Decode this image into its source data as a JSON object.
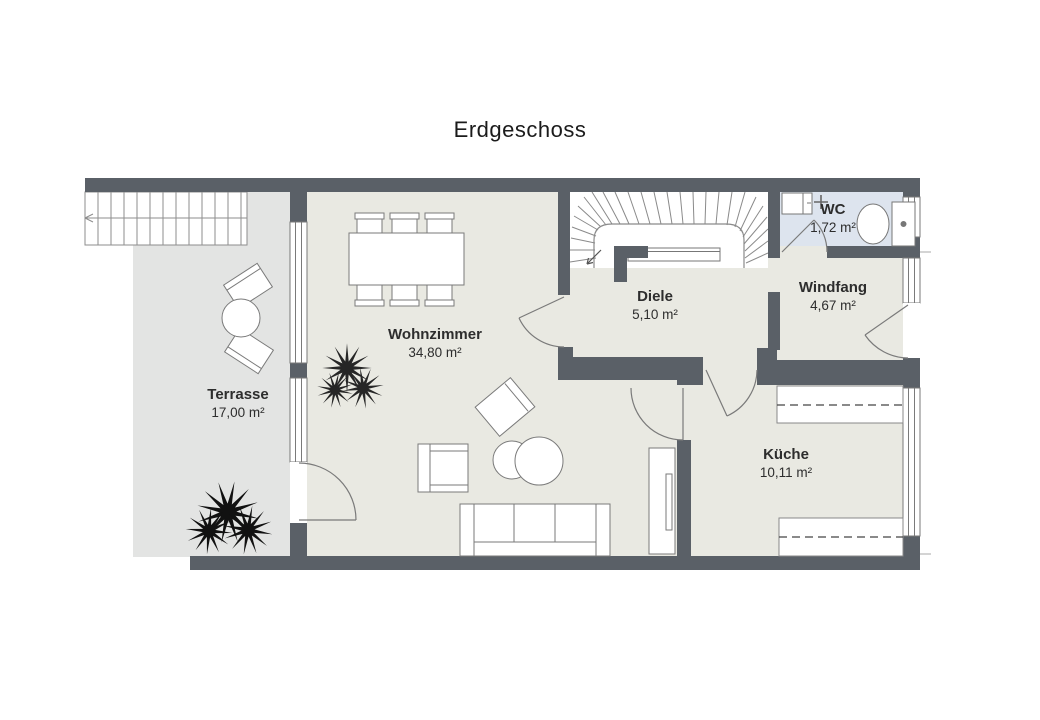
{
  "title": "Erdgeschoss",
  "rooms": {
    "terrasse": {
      "name": "Terrasse",
      "area": "17,00 m²"
    },
    "wohnzimmer": {
      "name": "Wohnzimmer",
      "area": "34,80 m²"
    },
    "diele": {
      "name": "Diele",
      "area": "5,10 m²"
    },
    "wc": {
      "name": "WC",
      "area": "1,72 m²"
    },
    "windfang": {
      "name": "Windfang",
      "area": "4,67 m²"
    },
    "kueche": {
      "name": "Küche",
      "area": "10,11 m²"
    }
  },
  "colors": {
    "wall": "#5a6067",
    "floor_main": "#e9e9e2",
    "floor_terrace": "#e3e4e3",
    "floor_wc": "#dde4ee",
    "background": "#ffffff"
  }
}
